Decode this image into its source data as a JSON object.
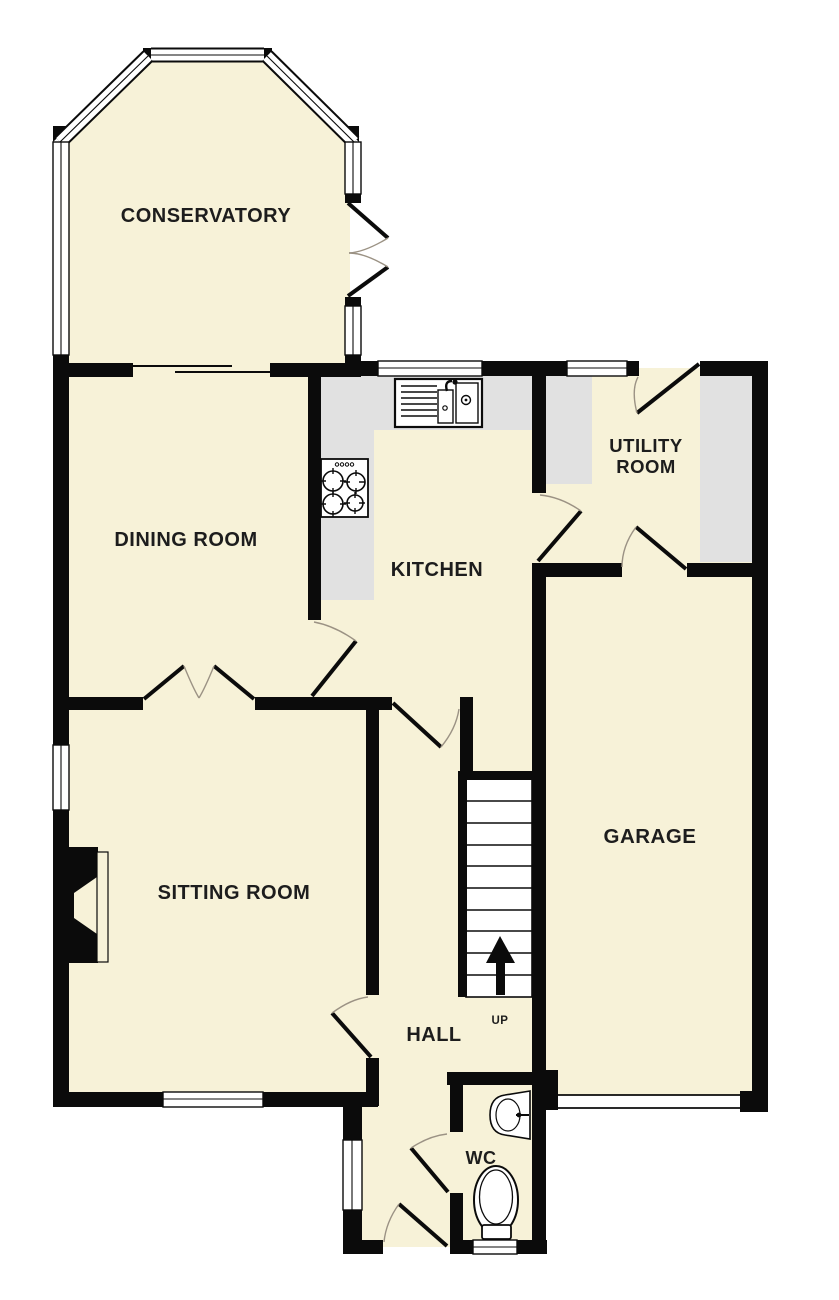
{
  "floorplan": {
    "colors": {
      "background": "#ffffff",
      "wall": "#0b0b0b",
      "room": "#f7f2d8",
      "counter": "#e1e1e1",
      "door_arc": "#9b9284",
      "label": "#1d1d1d"
    },
    "rooms": {
      "conservatory": {
        "label": "CONSERVATORY"
      },
      "dining_room": {
        "label": "DINING ROOM"
      },
      "kitchen": {
        "label": "KITCHEN"
      },
      "utility_room": {
        "label_line1": "UTILITY",
        "label_line2": "ROOM"
      },
      "sitting_room": {
        "label": "SITTING ROOM"
      },
      "garage": {
        "label": "GARAGE"
      },
      "hall": {
        "label": "HALL"
      },
      "wc": {
        "label": "WC"
      }
    },
    "stairs": {
      "label": "UP"
    }
  }
}
